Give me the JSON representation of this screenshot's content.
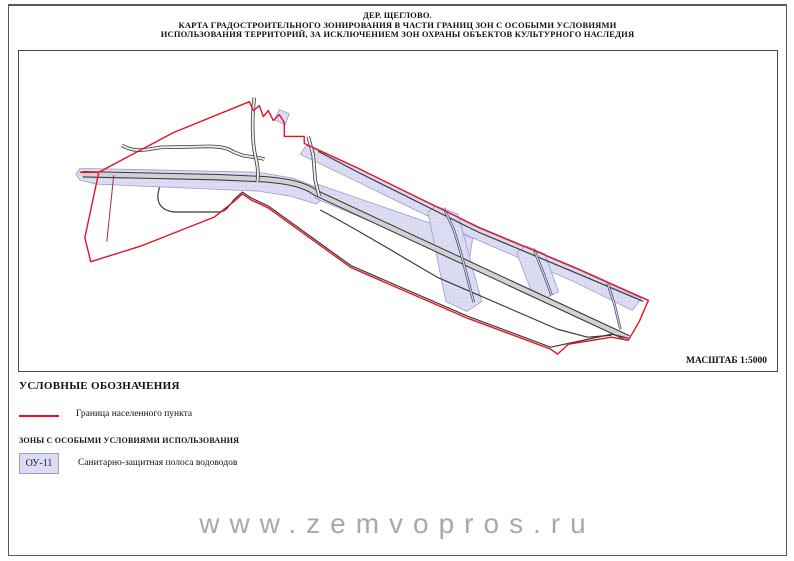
{
  "title": {
    "line1": "ДЕР. ЩЕГЛОВО.",
    "line2": "КАРТА ГРАДОСТРОИТЕЛЬНОГО ЗОНИРОВАНИЯ В ЧАСТИ ГРАНИЦ ЗОН С ОСОБЫМИ УСЛОВИЯМИ",
    "line3": "ИСПОЛЬЗОВАНИЯ ТЕРРИТОРИЙ, ЗА ИСКЛЮЧЕНИЕМ ЗОН ОХРАНЫ ОБЪЕКТОВ КУЛЬТУРНОГО НАСЛЕДИЯ"
  },
  "map": {
    "scale_label": "МАСШТАБ 1:5000",
    "geometry": {
      "boundary_main": "M 61,122 L 80,122 L 66,188 L 72,212 L 123,196 L 196,167 L 216,151 L 224,144 L 233,150 L 250,158 L 333,218 L 450,269 L 533,300 L 540,305 L 551,295 L 594,288 L 611,291 L 622,272 L 631,251 L 560,219 L 460,177 L 340,118 L 286,93 L 286,86 L 266,86 L 266,72 L 261,64 L 255,70 L 250,60 L 245,66 L 241,55 L 235,60 L 231,51 L 155,82 L 80,122",
      "boundary_inner": "M 95,125 L 88,192",
      "road_main": "M 64,124 L 200,127 L 245,129 C 272,131 287,135 298,143 L 611,289",
      "road_upper": "M 300,101 L 340,122 L 460,182 L 560,224 L 626,252",
      "road_mid": "M 302,160 C 340,180 382,206 420,228 L 540,280 L 570,288 L 594,286",
      "road_lower": "M 141,137 C 136,152 142,160 155,162 L 200,162 C 208,162 211,155 216,149 L 224,142 L 233,148 L 250,156 L 333,216 L 450,267 L 533,298 L 594,285 L 611,289",
      "road_lobe_curvy": "M 103,95 C 118,103 128,99 142,97 L 190,96 C 206,96 211,99 216,102 L 224,105 C 234,107 242,107 246,109",
      "road_lobe_v1": "M 236,47 C 233,70 234,96 238,110 C 240,119 240,125 239,132",
      "road_lobe_v2": "M 290,86 L 295,105 L 297,130 L 301,146",
      "road_cs1": "M 426,158 L 436,180 L 443,203 L 456,253",
      "road_cs2": "M 516,199 L 526,224 L 534,246",
      "road_cs3": "M 590,233 L 597,255 L 603,280",
      "zone_band_h": "M 57,124 L 61,118 L 240,122 L 275,128 L 298,137 L 307,146 L 298,154 L 272,146 L 240,141 L 78,134 L 61,130 Z",
      "zone_band_diag": "M 288,95 L 340,118 L 460,178 L 560,220 L 624,249 L 615,261 L 556,232 L 455,188 L 336,130 L 282,104 Z",
      "zone_band_blob": "M 299,134 L 455,188 L 451,213 L 297,148 Z",
      "zone_cs1": "M 418,156 L 440,164 L 464,252 L 449,262 L 428,252 L 410,162 Z",
      "zone_cs2": "M 508,196 L 527,204 L 541,242 L 528,249 L 513,240 L 499,203 Z",
      "zone_notch": "M 261,59 L 271,63 L 267,74 L 256,69 Z"
    }
  },
  "legend": {
    "title": "УСЛОВНЫЕ ОБОЗНАЧЕНИЯ",
    "boundary_item_label": "Граница населенного пункта",
    "zones_header": "ЗОНЫ С ОСОБЫМИ УСЛОВИЯМИ ИСПОЛЬЗОВАНИЯ",
    "zone_code": "ОУ-11",
    "zone_label": "Санитарно-защитная полоса водоводов"
  },
  "watermark": "www.zemvopros.ru",
  "colors": {
    "boundary_red": "#e81123",
    "zone_fill": "#dcdcf2",
    "zone_border": "#9c9cd0",
    "road_fill": "#d2d2d2",
    "road_casing": "#3a3a3a"
  }
}
